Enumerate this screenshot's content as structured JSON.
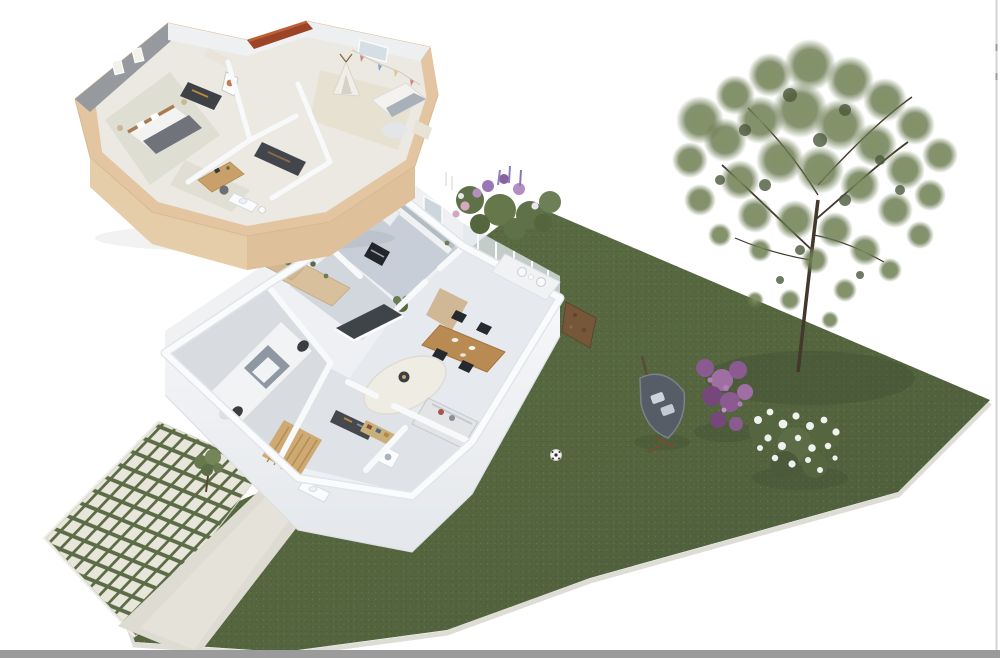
{
  "meta": {
    "title": "3D isometric rendering of a two-storey house plan: detached upper-floor plan at top left, ground floor with garage, kitchen and living room attached to a large garden lawn",
    "visible_text": []
  },
  "palette": {
    "background": "#ffffff",
    "lawn_green": "#57683f",
    "lawn_dark": "#44523a",
    "wall_beige": "#e3c5a1",
    "wall_white": "#f6f7f9",
    "floor_gray_blue": "#c7ced7",
    "wood": "#c9a36a",
    "roof_ridge_red": "#9c4526",
    "paver_light": "#e8e6da",
    "path_gray": "#dedbd2",
    "tree_green": "#6d7f57",
    "bush_purple": "#8a5a90",
    "bloom_white": "#eff1ec",
    "car_white": "#f2f3f5",
    "bottom_bar_gray": "#9b9b9b",
    "right_edge_gray": "#d4d4d4"
  },
  "scene": {
    "upper_floor": {
      "label": "upper floor plan with master bedroom, kids room with teepee, office nook, bathroom and wardrobes",
      "rooms": [
        "master bedroom with gray accent wall",
        "bedroom with framed picture",
        "kids bedroom with teepee and bunting",
        "office nook with wooden desk",
        "bathroom",
        "hallway with dark wardrobes"
      ],
      "roof": "terracotta ridge strip"
    },
    "ground_floor": {
      "label": "ground floor plan with garage, kitchen, pantry, living and dining room",
      "rooms": [
        "garage with white car",
        "kitchen with black oven and window",
        "pantry with wooden counters and plants",
        "living room with sofa, rug and island",
        "dining area with wooden table and black chairs",
        "entry hall with wooden staircase",
        "laundry and bathroom"
      ],
      "terrace": "small terrace with two white chairs"
    },
    "garden": {
      "label": "garden with lawn, mature tree, shrubs, lounger and paved driveway",
      "objects": [
        "large lawn",
        "mature tree",
        "purple flowering shrub",
        "white flowering shrub",
        "flower bed with lavender",
        "hanging lounger with cushions",
        "soccer ball",
        "checkered paver driveway with grass joints",
        "concrete path",
        "young sapling",
        "bare soil patch"
      ]
    },
    "chrome": {
      "bottom_bar": "window edge bar",
      "right_edge": "window edge line"
    }
  }
}
